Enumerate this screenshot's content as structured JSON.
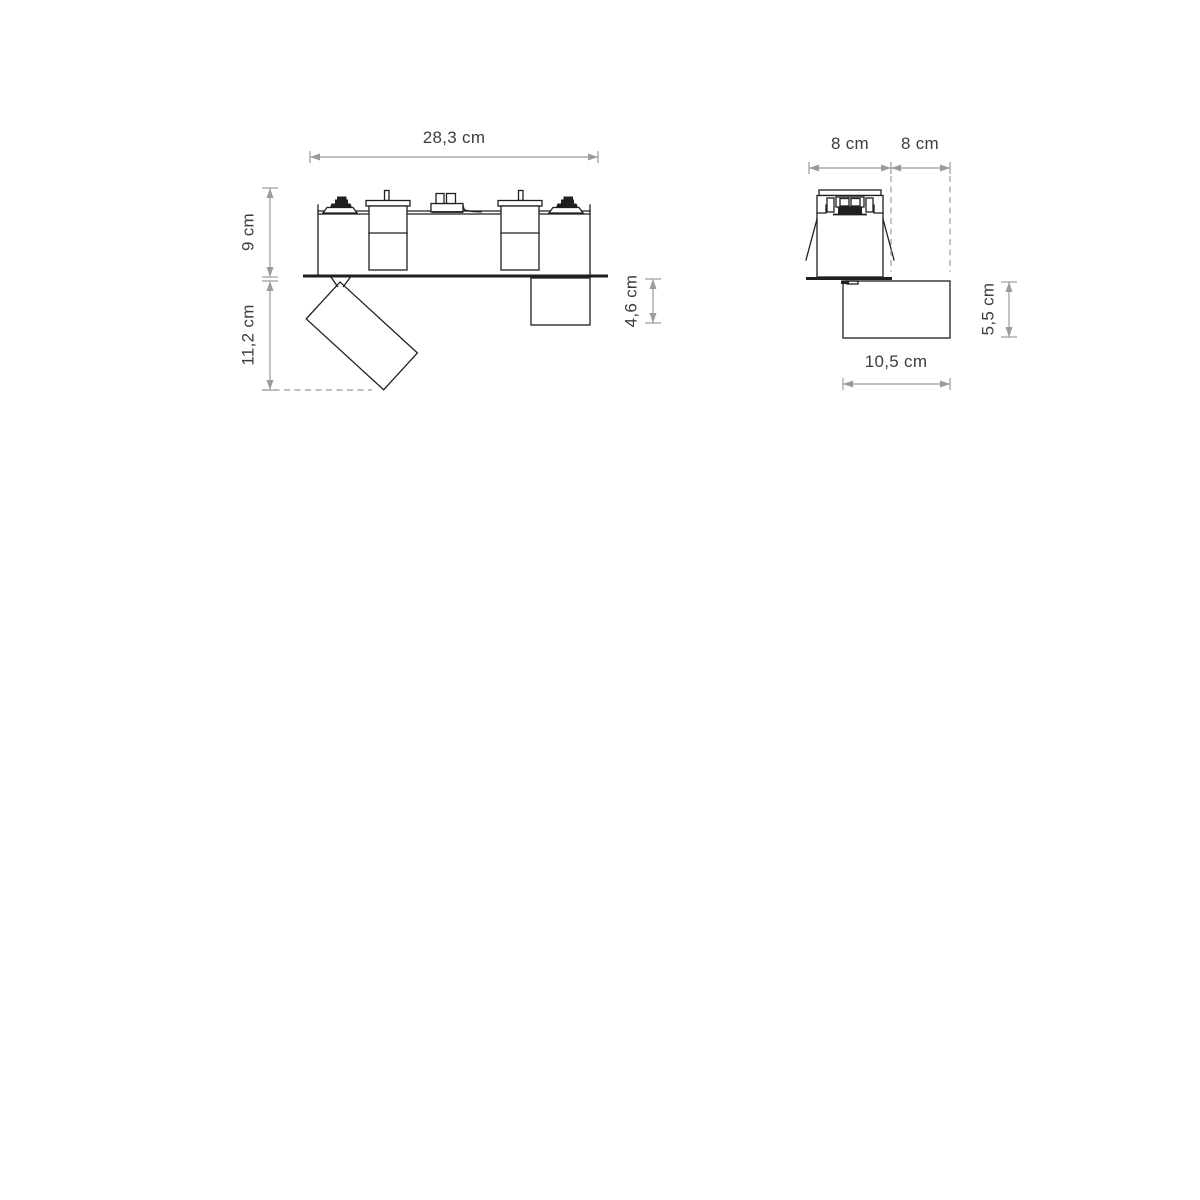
{
  "page": {
    "background": "#ffffff",
    "description": "Technical dimension drawing of a recessed track lighting fixture with adjustable spot heads, front view and side view"
  },
  "colors": {
    "outline": "#1f1f1f",
    "dimension_lines": "#9b9b9b",
    "label_text": "#3d3d3d"
  },
  "front_view": {
    "name": "front-view",
    "labels": {
      "total_width": "28,3 cm",
      "recessed_height": "9 cm",
      "spot_projection": "11,2 cm",
      "head_depth": "4,6 cm"
    }
  },
  "side_view": {
    "name": "side-view",
    "labels": {
      "recess_width": "8 cm",
      "side_clearance": "8 cm",
      "head_height": "5,5 cm",
      "head_length": "10,5 cm"
    }
  }
}
